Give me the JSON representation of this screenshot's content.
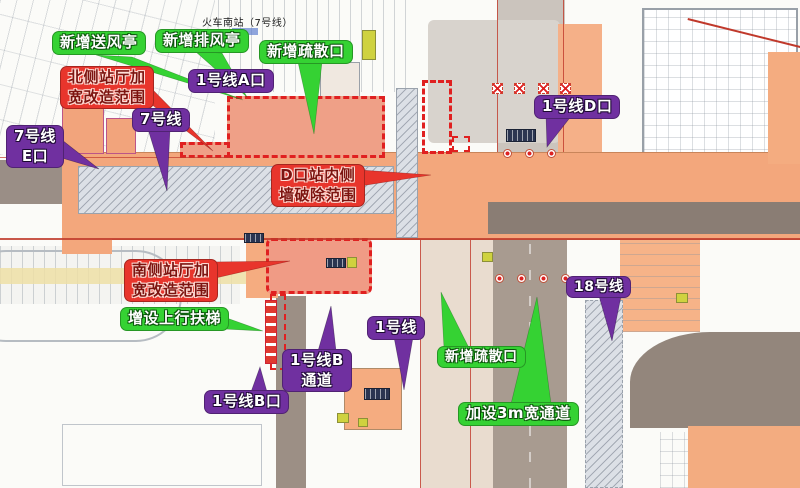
{
  "title": "火车南站（7号线）",
  "colors": {
    "callout_green": "#35d233",
    "callout_purple": "#7030a0",
    "callout_red": "#e8352c",
    "station_orange": "#f3a77c",
    "hall_salmon": "#f09b85",
    "road_gray": "#9c8f85",
    "hatch_gray": "#dce0e6",
    "dashed_outline_red": "#e02020"
  },
  "callouts": [
    {
      "id": "new-air-supply-pavilion",
      "style": "green",
      "lines": [
        "新增送风亭"
      ]
    },
    {
      "id": "new-exhaust-pavilion",
      "style": "green",
      "lines": [
        "新增排风亭"
      ]
    },
    {
      "id": "new-evacuation-exit-top",
      "style": "green",
      "lines": [
        "新增疏散口"
      ]
    },
    {
      "id": "line1-exit-a",
      "style": "purple",
      "lines": [
        "1号线A口"
      ]
    },
    {
      "id": "north-hall-widening",
      "style": "red",
      "lines": [
        "北侧站厅加",
        "宽改造范围"
      ]
    },
    {
      "id": "line7",
      "style": "purple",
      "lines": [
        "7号线"
      ]
    },
    {
      "id": "line7-exit-e",
      "style": "purple",
      "lines": [
        "7号线",
        "E口"
      ]
    },
    {
      "id": "line1-exit-d",
      "style": "purple",
      "lines": [
        "1号线D口"
      ]
    },
    {
      "id": "d-exit-inner-wall-demolition",
      "style": "red",
      "lines": [
        "D口站内侧",
        "墙破除范围"
      ]
    },
    {
      "id": "south-hall-widening",
      "style": "red",
      "lines": [
        "南侧站厅加",
        "宽改造范围"
      ]
    },
    {
      "id": "new-up-escalator",
      "style": "green",
      "lines": [
        "增设上行扶梯"
      ]
    },
    {
      "id": "line1-passage-b",
      "style": "purple",
      "lines": [
        "1号线B",
        "通道"
      ]
    },
    {
      "id": "line1-exit-b",
      "style": "purple",
      "lines": [
        "1号线B口"
      ]
    },
    {
      "id": "line1",
      "style": "purple",
      "lines": [
        "1号线"
      ]
    },
    {
      "id": "new-evacuation-exit-bottom",
      "style": "green",
      "lines": [
        "新增疏散口"
      ]
    },
    {
      "id": "new-3m-wide-passage",
      "style": "green",
      "lines": [
        "加设3m宽通道"
      ]
    },
    {
      "id": "line18",
      "style": "purple",
      "lines": [
        "18号线"
      ]
    }
  ]
}
